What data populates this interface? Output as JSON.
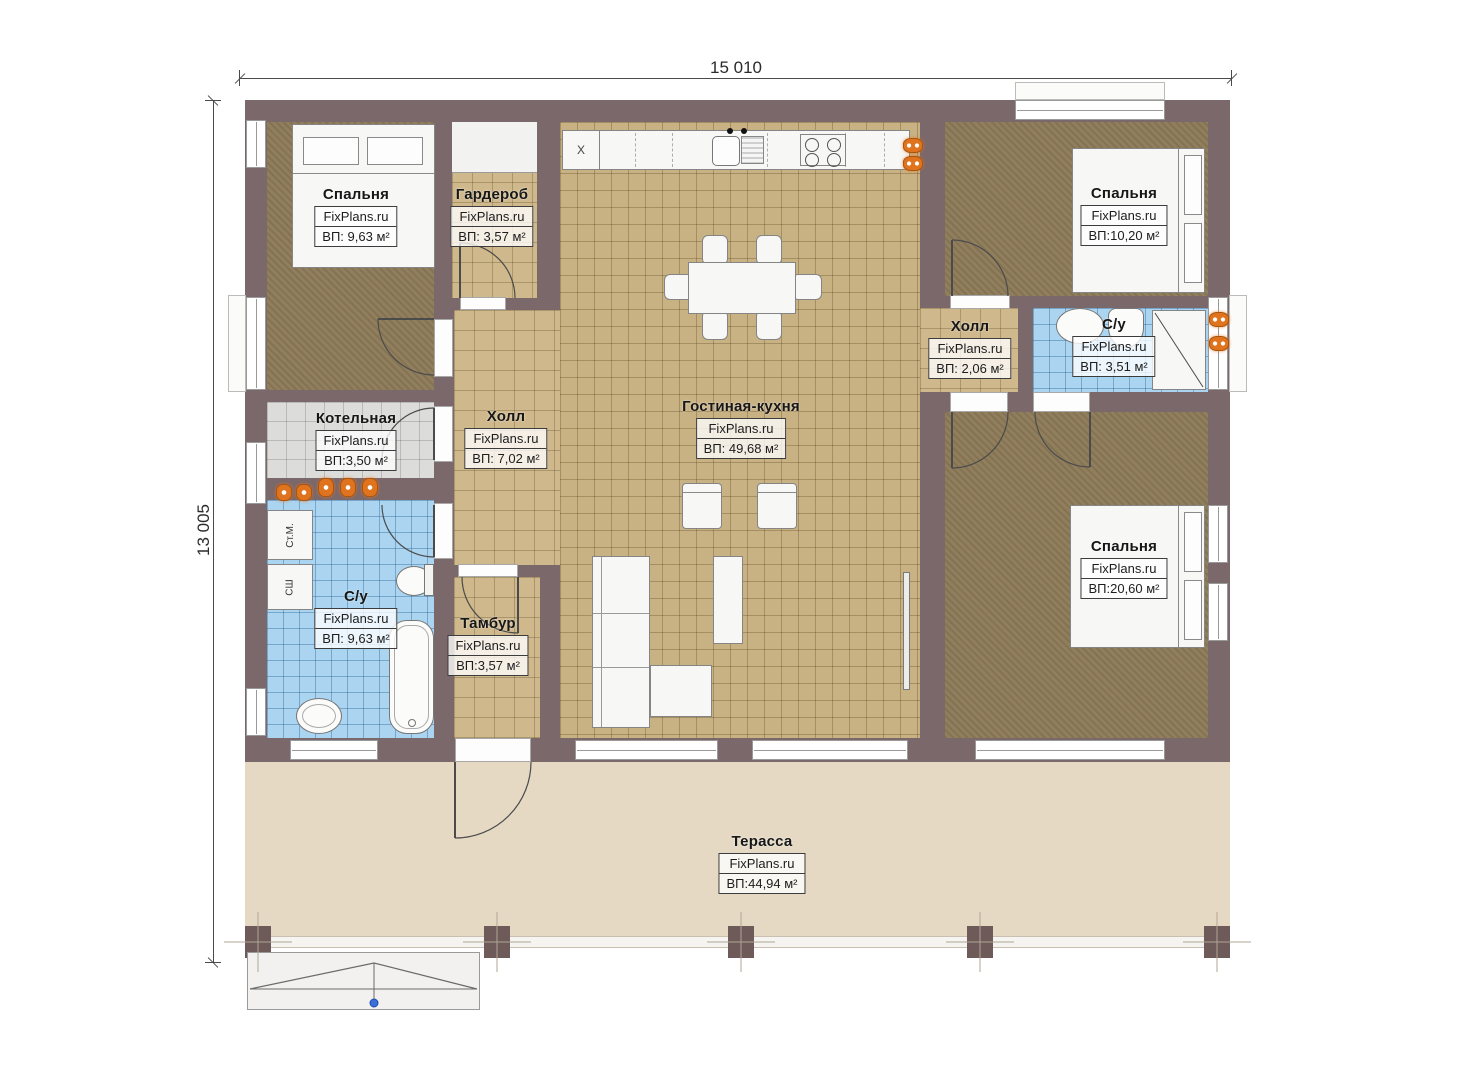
{
  "dimensions": {
    "top": "15 010",
    "left": "13 005"
  },
  "rooms": {
    "bedroom_tl": {
      "name": "Спальня",
      "brand": "FixPlans.ru",
      "area": "ВП: 9,63 м²"
    },
    "wardrobe": {
      "name": "Гардероб",
      "brand": "FixPlans.ru",
      "area": "ВП: 3,57 м²"
    },
    "bedroom_tr": {
      "name": "Спальня",
      "brand": "FixPlans.ru",
      "area": "ВП:10,20 м²"
    },
    "hall_small": {
      "name": "Холл",
      "brand": "FixPlans.ru",
      "area": "ВП: 2,06 м²"
    },
    "bathroom_right": {
      "name": "С/у",
      "brand": "FixPlans.ru",
      "area": "ВП: 3,51 м²"
    },
    "boiler": {
      "name": "Котельная",
      "brand": "FixPlans.ru",
      "area": "ВП:3,50 м²"
    },
    "hall_main": {
      "name": "Холл",
      "brand": "FixPlans.ru",
      "area": "ВП: 7,02 м²"
    },
    "living_kitchen": {
      "name": "Гостиная-кухня",
      "brand": "FixPlans.ru",
      "area": "ВП: 49,68 м²"
    },
    "bathroom_left": {
      "name": "С/у",
      "brand": "FixPlans.ru",
      "area": "ВП: 9,63 м²"
    },
    "vestibule": {
      "name": "Тамбур",
      "brand": "FixPlans.ru",
      "area": "ВП:3,57 м²"
    },
    "bedroom_br": {
      "name": "Спальня",
      "brand": "FixPlans.ru",
      "area": "ВП:20,60 м²"
    },
    "terrace": {
      "name": "Терасса",
      "brand": "FixPlans.ru",
      "area": "ВП:44,94 м²"
    }
  },
  "appliances": {
    "washing_machine": "Ст.М.",
    "dryer": "СШ",
    "fridge": "X"
  },
  "colors": {
    "wall": "#7b686b",
    "carpet": "#8c7a58",
    "tile_tan": "#c8b183",
    "tile_hall": "#cfb88c",
    "tile_gray": "#dcdcda",
    "tile_blue": "#abd4f0",
    "terrace": "#e5d9c4",
    "lamp_orange": "#e0731d",
    "marker_blue": "#3a6fd8"
  }
}
